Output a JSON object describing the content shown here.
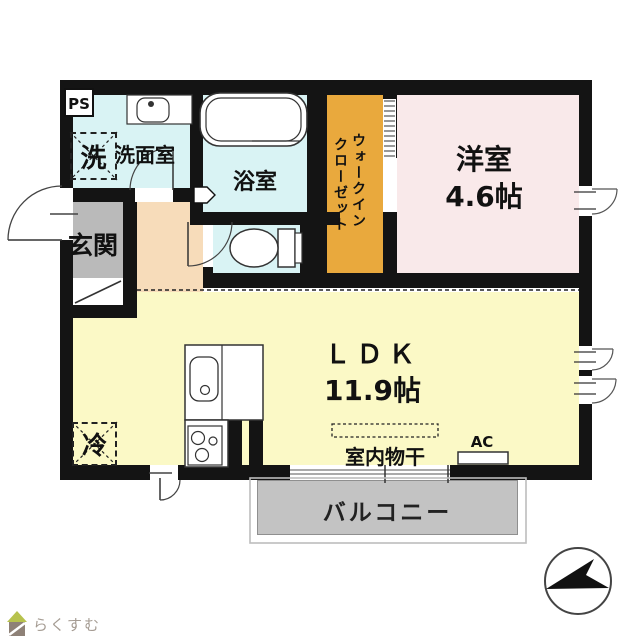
{
  "plan": {
    "rooms": {
      "western": {
        "name": "洋室",
        "area": "4.6帖"
      },
      "ldk": {
        "name": "ＬＤＫ",
        "area": "11.9帖"
      },
      "bathroom": {
        "name": "浴室"
      },
      "washroom": {
        "name": "洗面室"
      },
      "entrance": {
        "name": "玄関"
      },
      "wic": {
        "name": "ウォークインクローゼット",
        "lines": [
          "ウォークイン",
          "クローゼット"
        ]
      },
      "balcony": {
        "name": "バルコニー"
      }
    },
    "fixtures": {
      "pipe_space": "PS",
      "washer": "洗",
      "fridge": "冷",
      "indoor_drying": "室内物干",
      "air_con": "AC"
    },
    "colors": {
      "wall": "#141414",
      "western": "#F9E9EA",
      "ldk": "#FBF9C6",
      "wet": "#D9F3F4",
      "wic": "#E9A93D",
      "hallway": "#F7DCBA",
      "entrance": "#BABABA",
      "balcony": "#C3C3C3"
    }
  },
  "footer": {
    "logo_text": "らくすむ"
  }
}
